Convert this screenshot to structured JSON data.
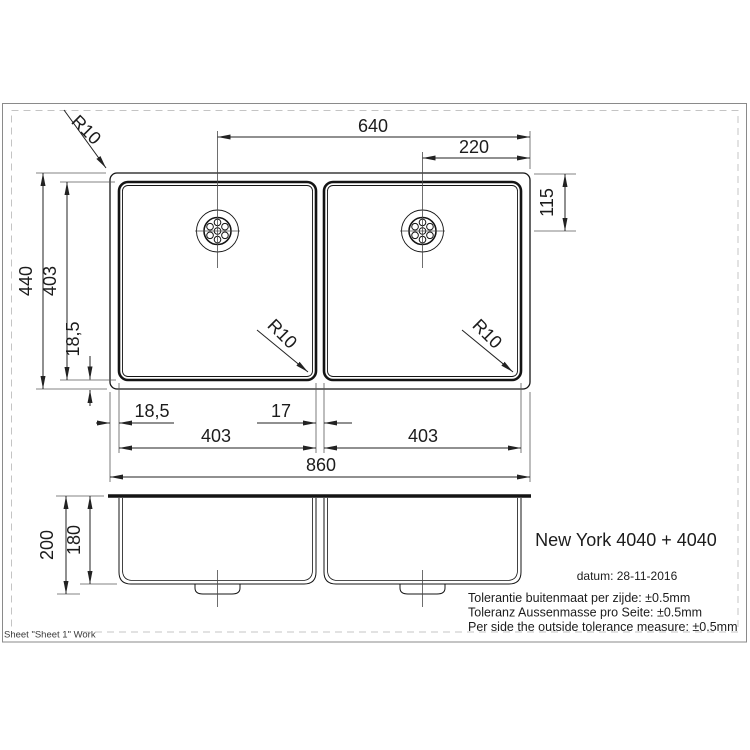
{
  "frame": {
    "sheet_label": "Sheet \"Sheet 1\" Work"
  },
  "title_block": {
    "product_name": "New York 4040 + 4040",
    "date": "datum: 28-11-2016",
    "tolerance_nl": "Tolerantie buitenmaat per zijde: ±0.5mm",
    "tolerance_de": "Toleranz Aussenmasse pro Seite: ±0.5mm",
    "tolerance_en": "Per side the outside tolerance measure: ±0.5mm"
  },
  "top_view": {
    "dim_drain_to_right_edge": "640",
    "dim_drain_offset_right": "220",
    "dim_drain_from_top": "115",
    "dim_overall_depth": "440",
    "dim_bowl_depth": "403",
    "dim_rim_bottom": "18,5",
    "dim_rim_left": "18,5",
    "dim_divider": "17",
    "dim_bowl_width_left": "403",
    "dim_bowl_width_right": "403",
    "dim_overall_width": "860",
    "radius_outer_corner": "R10",
    "radius_bowl_left": "R10",
    "radius_bowl_right": "R10"
  },
  "side_view": {
    "dim_total_height": "200",
    "dim_bowl_height": "180"
  }
}
